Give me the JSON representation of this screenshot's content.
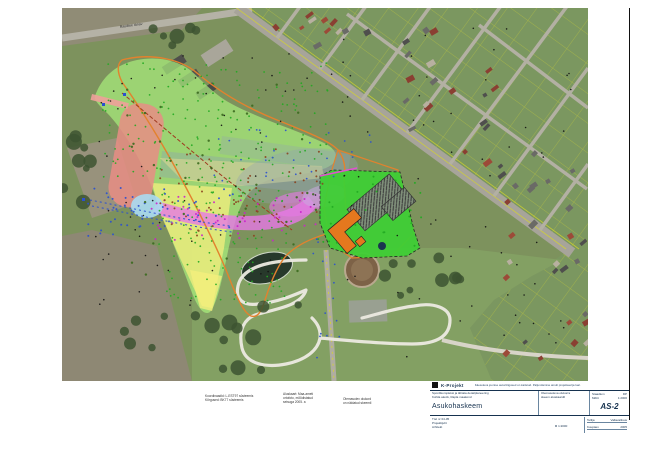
{
  "map": {
    "seed": 7,
    "road_label": "Raudtee tänav",
    "colors": {
      "plan_area_green": "#aaf07e",
      "zone_yellow": "#f4ef7d",
      "zone_red": "#e88d85",
      "zone_magenta": "#e678e6",
      "zone_lightblue": "#aadcf2",
      "zone_lavender": "#c9aade",
      "shadow_band": "#8fa0b0",
      "boundary_orange": "#e2822e",
      "school_green": "#3fcf35",
      "building_orange": "#e5781e",
      "parcel_yellow": "#d8d830",
      "points_blue": "#2b50d0",
      "points_green": "#22aa22",
      "points_magenta": "#cc22cc"
    },
    "point_clusters": [
      {
        "color": "#22aa22",
        "n": 150,
        "x": 40,
        "y": 55,
        "w": 230,
        "h": 115,
        "r": 0.9
      },
      {
        "color": "#22aa22",
        "n": 120,
        "x": 95,
        "y": 170,
        "w": 135,
        "h": 125,
        "r": 0.9
      },
      {
        "color": "#22aa22",
        "n": 25,
        "x": 255,
        "y": 165,
        "w": 105,
        "h": 80,
        "r": 1.0
      },
      {
        "color": "#111111",
        "n": 70,
        "x": 30,
        "y": 40,
        "w": 260,
        "h": 265,
        "r": 0.8
      },
      {
        "color": "#111111",
        "n": 55,
        "x": 280,
        "y": 20,
        "w": 240,
        "h": 330,
        "r": 0.8
      },
      {
        "color": "#2b50d0",
        "n": 50,
        "x": 25,
        "y": 180,
        "w": 150,
        "h": 48,
        "r": 1.0
      },
      {
        "color": "#2b50d0",
        "n": 30,
        "x": 150,
        "y": 118,
        "w": 160,
        "h": 55,
        "r": 0.9
      },
      {
        "color": "#2b50d0",
        "n": 14,
        "x": 250,
        "y": 230,
        "w": 30,
        "h": 120,
        "r": 0.9
      },
      {
        "color": "#cc22cc",
        "n": 45,
        "x": 85,
        "y": 188,
        "w": 170,
        "h": 45,
        "r": 1.0
      },
      {
        "color": "#8a4420",
        "n": 60,
        "x": 95,
        "y": 140,
        "w": 170,
        "h": 90,
        "r": 1.0
      },
      {
        "color": "#3b6b1f",
        "n": 40,
        "x": 60,
        "y": 70,
        "w": 200,
        "h": 200,
        "r": 1.2
      }
    ],
    "house_clusters": [
      {
        "n": 10,
        "x": 250,
        "y": 10,
        "w": 120,
        "h": 50
      },
      {
        "n": 12,
        "x": 330,
        "y": 60,
        "w": 140,
        "h": 70
      },
      {
        "n": 12,
        "x": 400,
        "y": 130,
        "w": 120,
        "h": 80
      },
      {
        "n": 10,
        "x": 440,
        "y": 210,
        "w": 86,
        "h": 60
      },
      {
        "n": 8,
        "x": 430,
        "y": 300,
        "w": 96,
        "h": 70
      },
      {
        "n": 6,
        "x": 195,
        "y": 0,
        "w": 80,
        "h": 30
      }
    ],
    "house_palette": [
      "#4f4f4d",
      "#8a3f32",
      "#b8b0a0",
      "#6a6a66",
      "#9c4a38"
    ],
    "tree_clusters": [
      {
        "n": 8,
        "x": 0,
        "y": 80,
        "w": 40,
        "h": 120
      },
      {
        "n": 6,
        "x": 60,
        "y": 300,
        "w": 80,
        "h": 50
      },
      {
        "n": 10,
        "x": 150,
        "y": 295,
        "w": 90,
        "h": 70
      },
      {
        "n": 5,
        "x": 300,
        "y": 255,
        "w": 60,
        "h": 40
      },
      {
        "n": 6,
        "x": 90,
        "y": 18,
        "w": 60,
        "h": 25
      },
      {
        "n": 5,
        "x": 340,
        "y": 248,
        "w": 60,
        "h": 30
      }
    ]
  },
  "notes": {
    "block1_lines": [
      "Koordinaadid: L-EST97 süsteemis",
      "Kõrgused: BK77 süsteemis"
    ],
    "block2_lines": [
      "Aluskaart: Maa-ameti",
      "ortofoto, mõõdistatud",
      "seisuga 2005. a"
    ],
    "block3_lines": [
      "Olemasolev olukord",
      "on näidatud skeemil"
    ]
  },
  "title_block": {
    "company": "K-Projekt",
    "copyright": "Käesoleva joonise autoriõigused on kaitstud. Paljundamine ainult projekteerija loal.",
    "project_label": "Spordikompleksi ja lähiala detailplaneering",
    "project_sub": "Kohila alevik, Rapla maakond",
    "sheet_title": "Asukohaskeem",
    "mid_line1": "Olemasoleva olukorra",
    "mid_line2": "skeem aluskaardil",
    "stage_label": "Staadium",
    "stage_value": "DP",
    "scale_label": "Mõõt",
    "scale_value": "1:2000",
    "sheet_no": "AS-2",
    "work_no_label": "Töö nr 04-05",
    "work_line2": "Projektijuht",
    "work_line3": "Arhitekt",
    "bottom_center": "M 1:2000",
    "client_label": "Tellija",
    "client_value": "Vallavalitsus",
    "date_label": "Kuupäev",
    "date_value": "2005"
  }
}
